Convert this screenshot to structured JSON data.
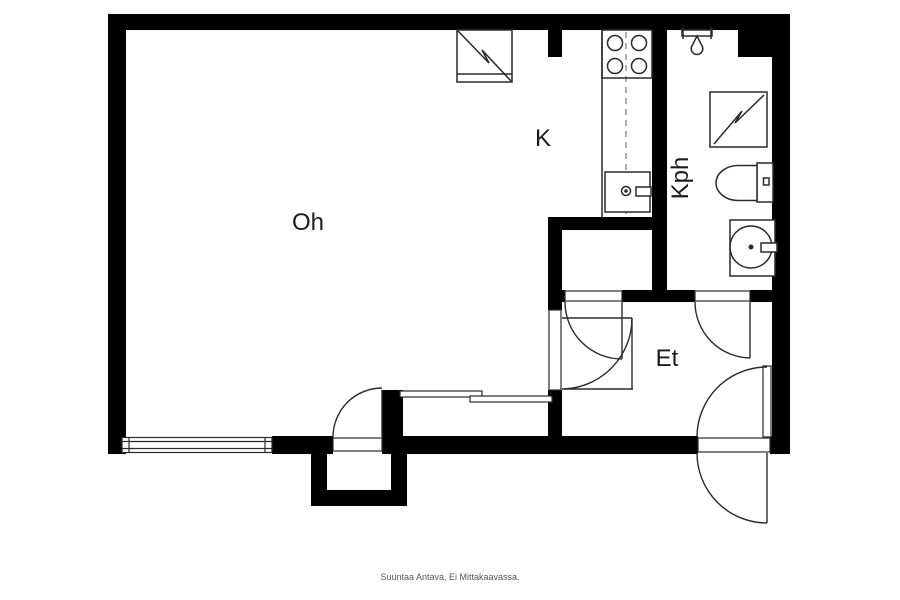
{
  "floorplan": {
    "rooms": {
      "living_room": {
        "label": "Oh"
      },
      "kitchen": {
        "label": "K"
      },
      "bathroom": {
        "label": "Kph"
      },
      "hallway": {
        "label": "Et"
      }
    },
    "footer": {
      "disclaimer": "Suuntaa Antava, Ei Mittakaavassa."
    },
    "icons": [
      "stove-icon",
      "kitchen-sink-icon",
      "fridge-appliance-icon",
      "washing-machine-icon",
      "shower-icon",
      "toilet-icon",
      "washbasin-icon",
      "window-icon",
      "sliding-door-icon",
      "door-swing-icon"
    ],
    "colors": {
      "walls": "#000000",
      "lines": "#2a2a2a",
      "dashed_line": "#9a9a9a",
      "footer_text": "#555555",
      "background": "#ffffff"
    }
  }
}
